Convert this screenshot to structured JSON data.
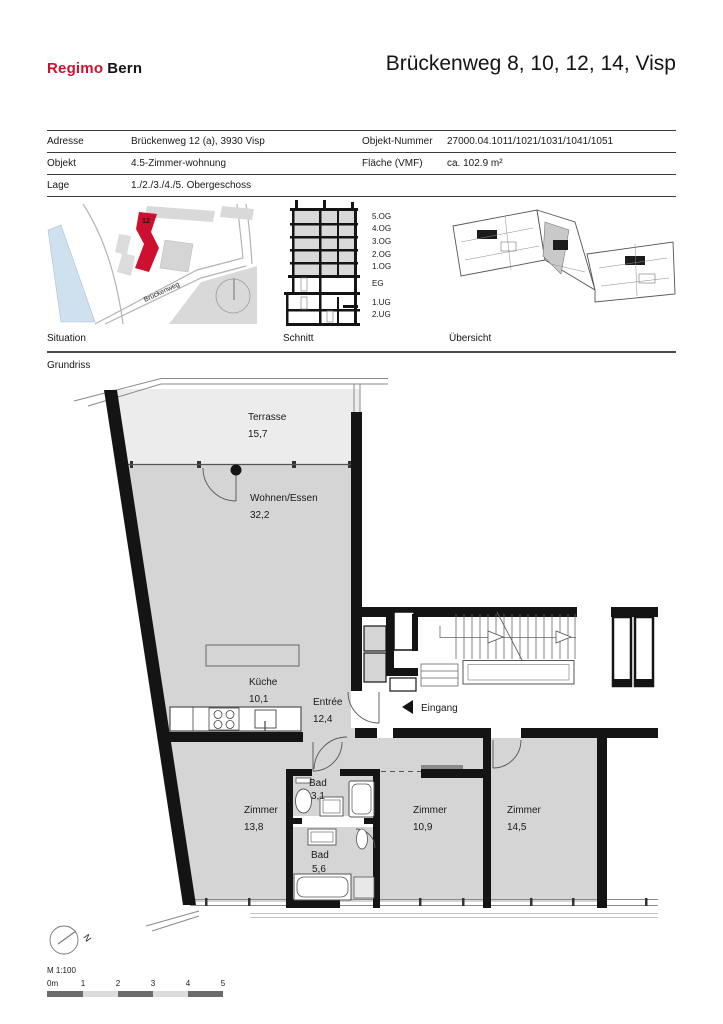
{
  "header": {
    "logo_primary": "Regimo",
    "logo_secondary": "Bern",
    "title": "Brückenweg 8, 10, 12, 14, Visp"
  },
  "info_table": {
    "rows": [
      {
        "c1": "Adresse",
        "c2": "Brückenweg 12 (a), 3930 Visp",
        "c3": "Objekt-Nummer",
        "c4": "27000.04.1011/1021/1031/1041/1051"
      },
      {
        "c1": "Objekt",
        "c2": "4.5-Zimmer-wohnung",
        "c3": "Fläche (VMF)",
        "c4": "ca. 102.9 m²"
      },
      {
        "c1": "Lage",
        "c2": "1./2./3./4./5. Obergeschoss",
        "c3": "",
        "c4": ""
      }
    ]
  },
  "thumbnails": {
    "situation_label": "Situation",
    "schnitt_label": "Schnitt",
    "uebersicht_label": "Übersicht",
    "map_building_number": "12",
    "map_street": "Brückenweg",
    "floor_labels": [
      "5.OG",
      "4.OG",
      "3.OG",
      "2.OG",
      "1.OG",
      "EG",
      "1.UG",
      "2.UG"
    ]
  },
  "plan": {
    "section_label": "Grundriss",
    "entrance_label": "Eingang",
    "rooms": [
      {
        "name": "Terrasse",
        "area": "15,7"
      },
      {
        "name": "Wohnen/Essen",
        "area": "32,2"
      },
      {
        "name": "Küche",
        "area": "10,1"
      },
      {
        "name": "Entrée",
        "area": "12,4"
      },
      {
        "name": "Zimmer",
        "area": "13,8"
      },
      {
        "name": "Bad",
        "area": "3,1"
      },
      {
        "name": "Bad",
        "area": "5,6"
      },
      {
        "name": "Zimmer",
        "area": "10,9"
      },
      {
        "name": "Zimmer",
        "area": "14,5"
      }
    ]
  },
  "footer": {
    "north_label": "N",
    "scale_label": "M 1:100",
    "scale_ticks": [
      "0m",
      "1",
      "2",
      "3",
      "4",
      "5"
    ]
  },
  "colors": {
    "accent_red": "#d0102f",
    "wall_black": "#141414",
    "room_fill": "#d5d5d5",
    "terrace_fill": "#ececec",
    "river_blue": "#cfe0ee",
    "map_building_gray": "#d9d9d9"
  }
}
